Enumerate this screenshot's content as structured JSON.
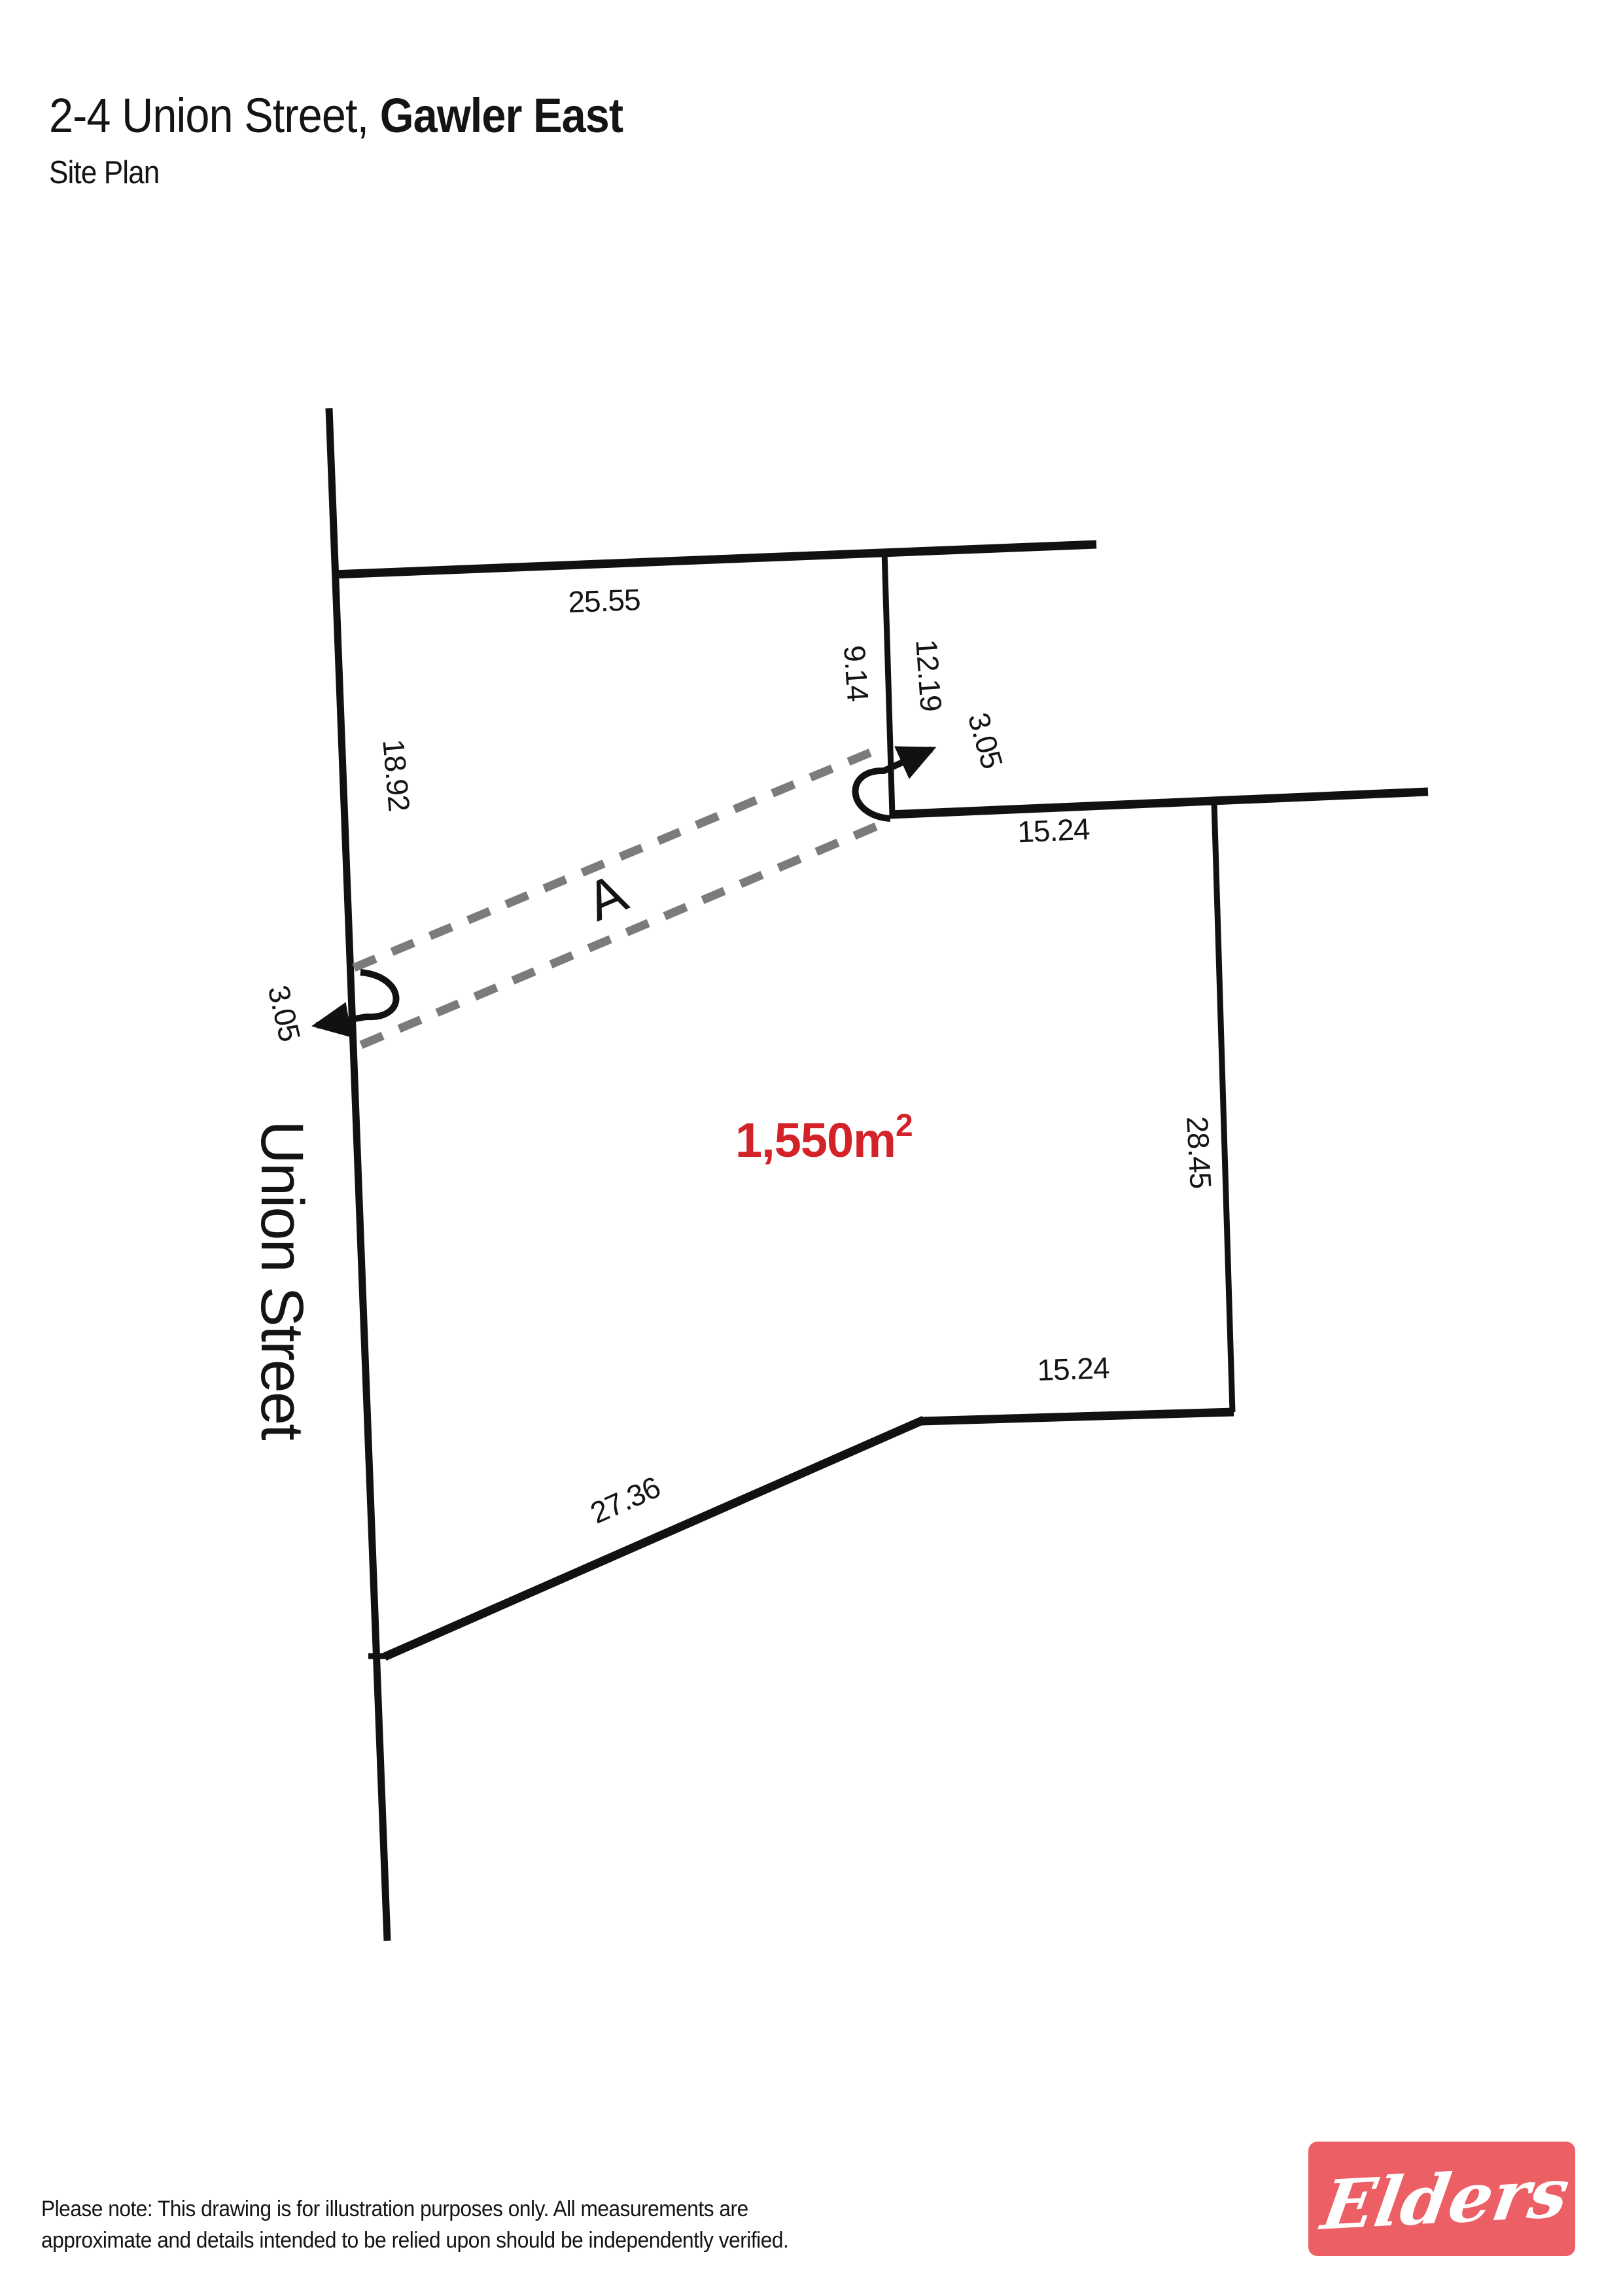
{
  "header": {
    "title_regular": "2-4 Union Street, ",
    "title_bold": "Gawler East",
    "subtitle": "Site Plan"
  },
  "plan": {
    "street_name": "Union Street",
    "area_label": {
      "base": "1,550m",
      "exponent": "2"
    },
    "easement_label": "A",
    "dimensions": {
      "top_boundary": "25.55",
      "left_upper": "18.92",
      "left_lower": "28.73",
      "partition_upper": "9.14",
      "partition_lower": "12.19",
      "easement_width_right": "3.05",
      "easement_width_left": "3.05",
      "east_upper": "15.24",
      "east_side": "28.45",
      "south": "15.24",
      "southwest_diagonal": "27.36"
    },
    "colors": {
      "line": "#111111",
      "easement_dash": "#7b7b7b",
      "area_text": "#d42328",
      "logo_red": "#ec5f65"
    }
  },
  "footer": {
    "note_line1": "Please note: This drawing is for illustration purposes only. All measurements are",
    "note_line2": "approximate and details intended to be relied upon should be independently verified."
  },
  "logo": {
    "brand": "Elders"
  }
}
